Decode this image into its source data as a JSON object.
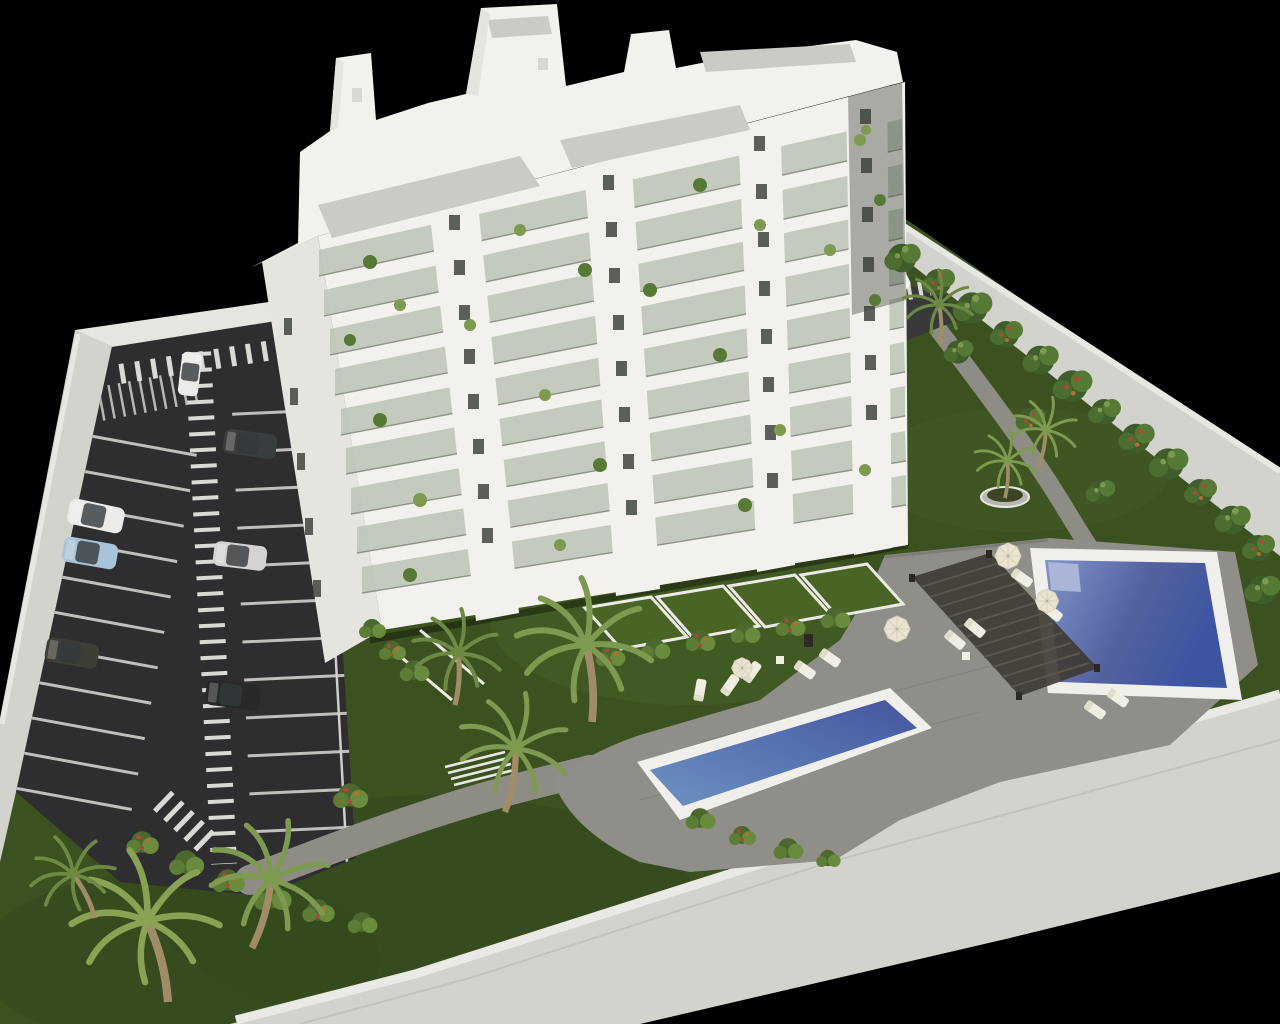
{
  "scene": {
    "type": "architectural-3d-render",
    "description": "Aerial axonometric 3D rendering of a white multi-storey apartment block with landscaped grounds on a black background",
    "setting": "night-black backdrop, daylight-lit model",
    "areas": [
      "apartment-building",
      "parking-lot",
      "lawn-gardens",
      "pool-deck",
      "private-ground-floor-terraces",
      "perimeter-wall"
    ]
  },
  "building": {
    "storeys_visible": 9,
    "facade_style": "white concrete with glass-fronted balconies and planters",
    "roof": "white penthouse volumes with grey gravel terraces",
    "balcony_plants": true
  },
  "parking": {
    "surface": "dark asphalt",
    "features": [
      "white stall lines",
      "central zebra pedestrian walkway",
      "top zebra crossing",
      "motorbike bays",
      "exit zebra near building"
    ],
    "cars": [
      {
        "color_name": "white",
        "location": "entry lane top"
      },
      {
        "color_name": "dark-grey",
        "location": "upper right stall"
      },
      {
        "color_name": "white-suv",
        "location": "left column"
      },
      {
        "color_name": "light-blue",
        "location": "left column"
      },
      {
        "color_name": "silver",
        "location": "right column"
      },
      {
        "color_name": "dark-olive",
        "location": "lower left stall"
      },
      {
        "color_name": "black",
        "location": "lower right stall"
      },
      {
        "color_name": "white-van",
        "location": "service lane by right wall"
      }
    ]
  },
  "pools": [
    {
      "name": "main-pool",
      "shape": "rectangular, tilted",
      "water": "deep blue",
      "position": "upper right deck"
    },
    {
      "name": "lap-pool",
      "shape": "long narrow rectangle",
      "water": "blue",
      "position": "lower centre deck"
    }
  ],
  "amenities": [
    "slatted pergola",
    "sun loungers",
    "cream parasols",
    "round palm planter",
    "garden paths",
    "steps"
  ],
  "vegetation": [
    "palm trees",
    "flowering shrubs along perimeter wall",
    "hedge rows",
    "lawn"
  ],
  "colors": {
    "background": "#000000",
    "wall_top": "#e6e6e1",
    "wall_face": "#d3d3cd",
    "wall_shade": "#b9b9b3",
    "asphalt": "#2e2d2f",
    "marking_white": "#d9d9d6",
    "lawn": "#3c5120",
    "lawn_light": "#4e6a2a",
    "lawn_dark": "#2f421a",
    "foliage_dark": "#3f5c2b",
    "foliage": "#567a35",
    "foliage_light": "#7d9a50",
    "flower_red": "#a84b38",
    "flower_orange": "#b5702f",
    "palm_trunk": "#a08d67",
    "building_white": "#f2f1ed",
    "building_shade": "#e6e4de",
    "glass_balcony": "#b9c0b2",
    "railing": "#7c8177",
    "window_dark": "#41463e",
    "roof_gravel": "#cbcbc6",
    "deck_gray": "#8f8e88",
    "deck_dark": "#767570",
    "path_gray": "#8d8d86",
    "pool_rim": "#f0efeb",
    "water_light": "#8095ca",
    "water_deep": "#3c54a2",
    "water_teal": "#6f92c0",
    "pergola_dark": "#3f3b34",
    "pergola_slat": "#5a554b",
    "lounger_cream": "#f0ede3",
    "umbrella_cream": "#eae4d3",
    "car_white": "#ebebe9",
    "car_silver": "#d2d3d2",
    "car_blue": "#a9c4d8",
    "car_dark": "#3a3d3f",
    "car_black": "#26282a"
  }
}
